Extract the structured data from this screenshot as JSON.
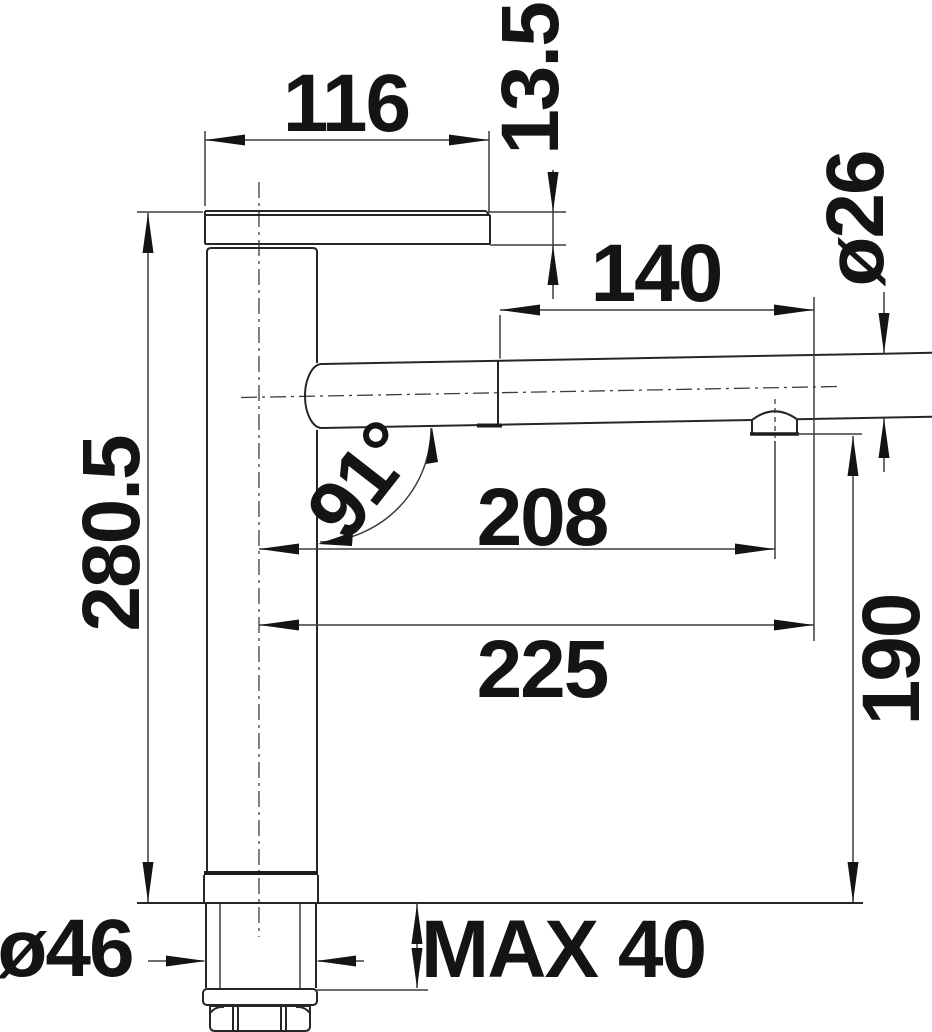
{
  "drawing": {
    "kind": "faucet-dimension-drawing",
    "units_shown": "mm"
  },
  "dimensions": {
    "lever_width": "116",
    "lever_plate_thickness": "13.5",
    "wand_length": "140",
    "spout_diameter": "ø26",
    "total_height": "280.5",
    "spout_angle": "91°",
    "aerator_offset": "208",
    "spout_reach": "225",
    "outlet_height": "190",
    "base_diameter": "ø46",
    "max_mounting_thickness": "MAX 40"
  }
}
